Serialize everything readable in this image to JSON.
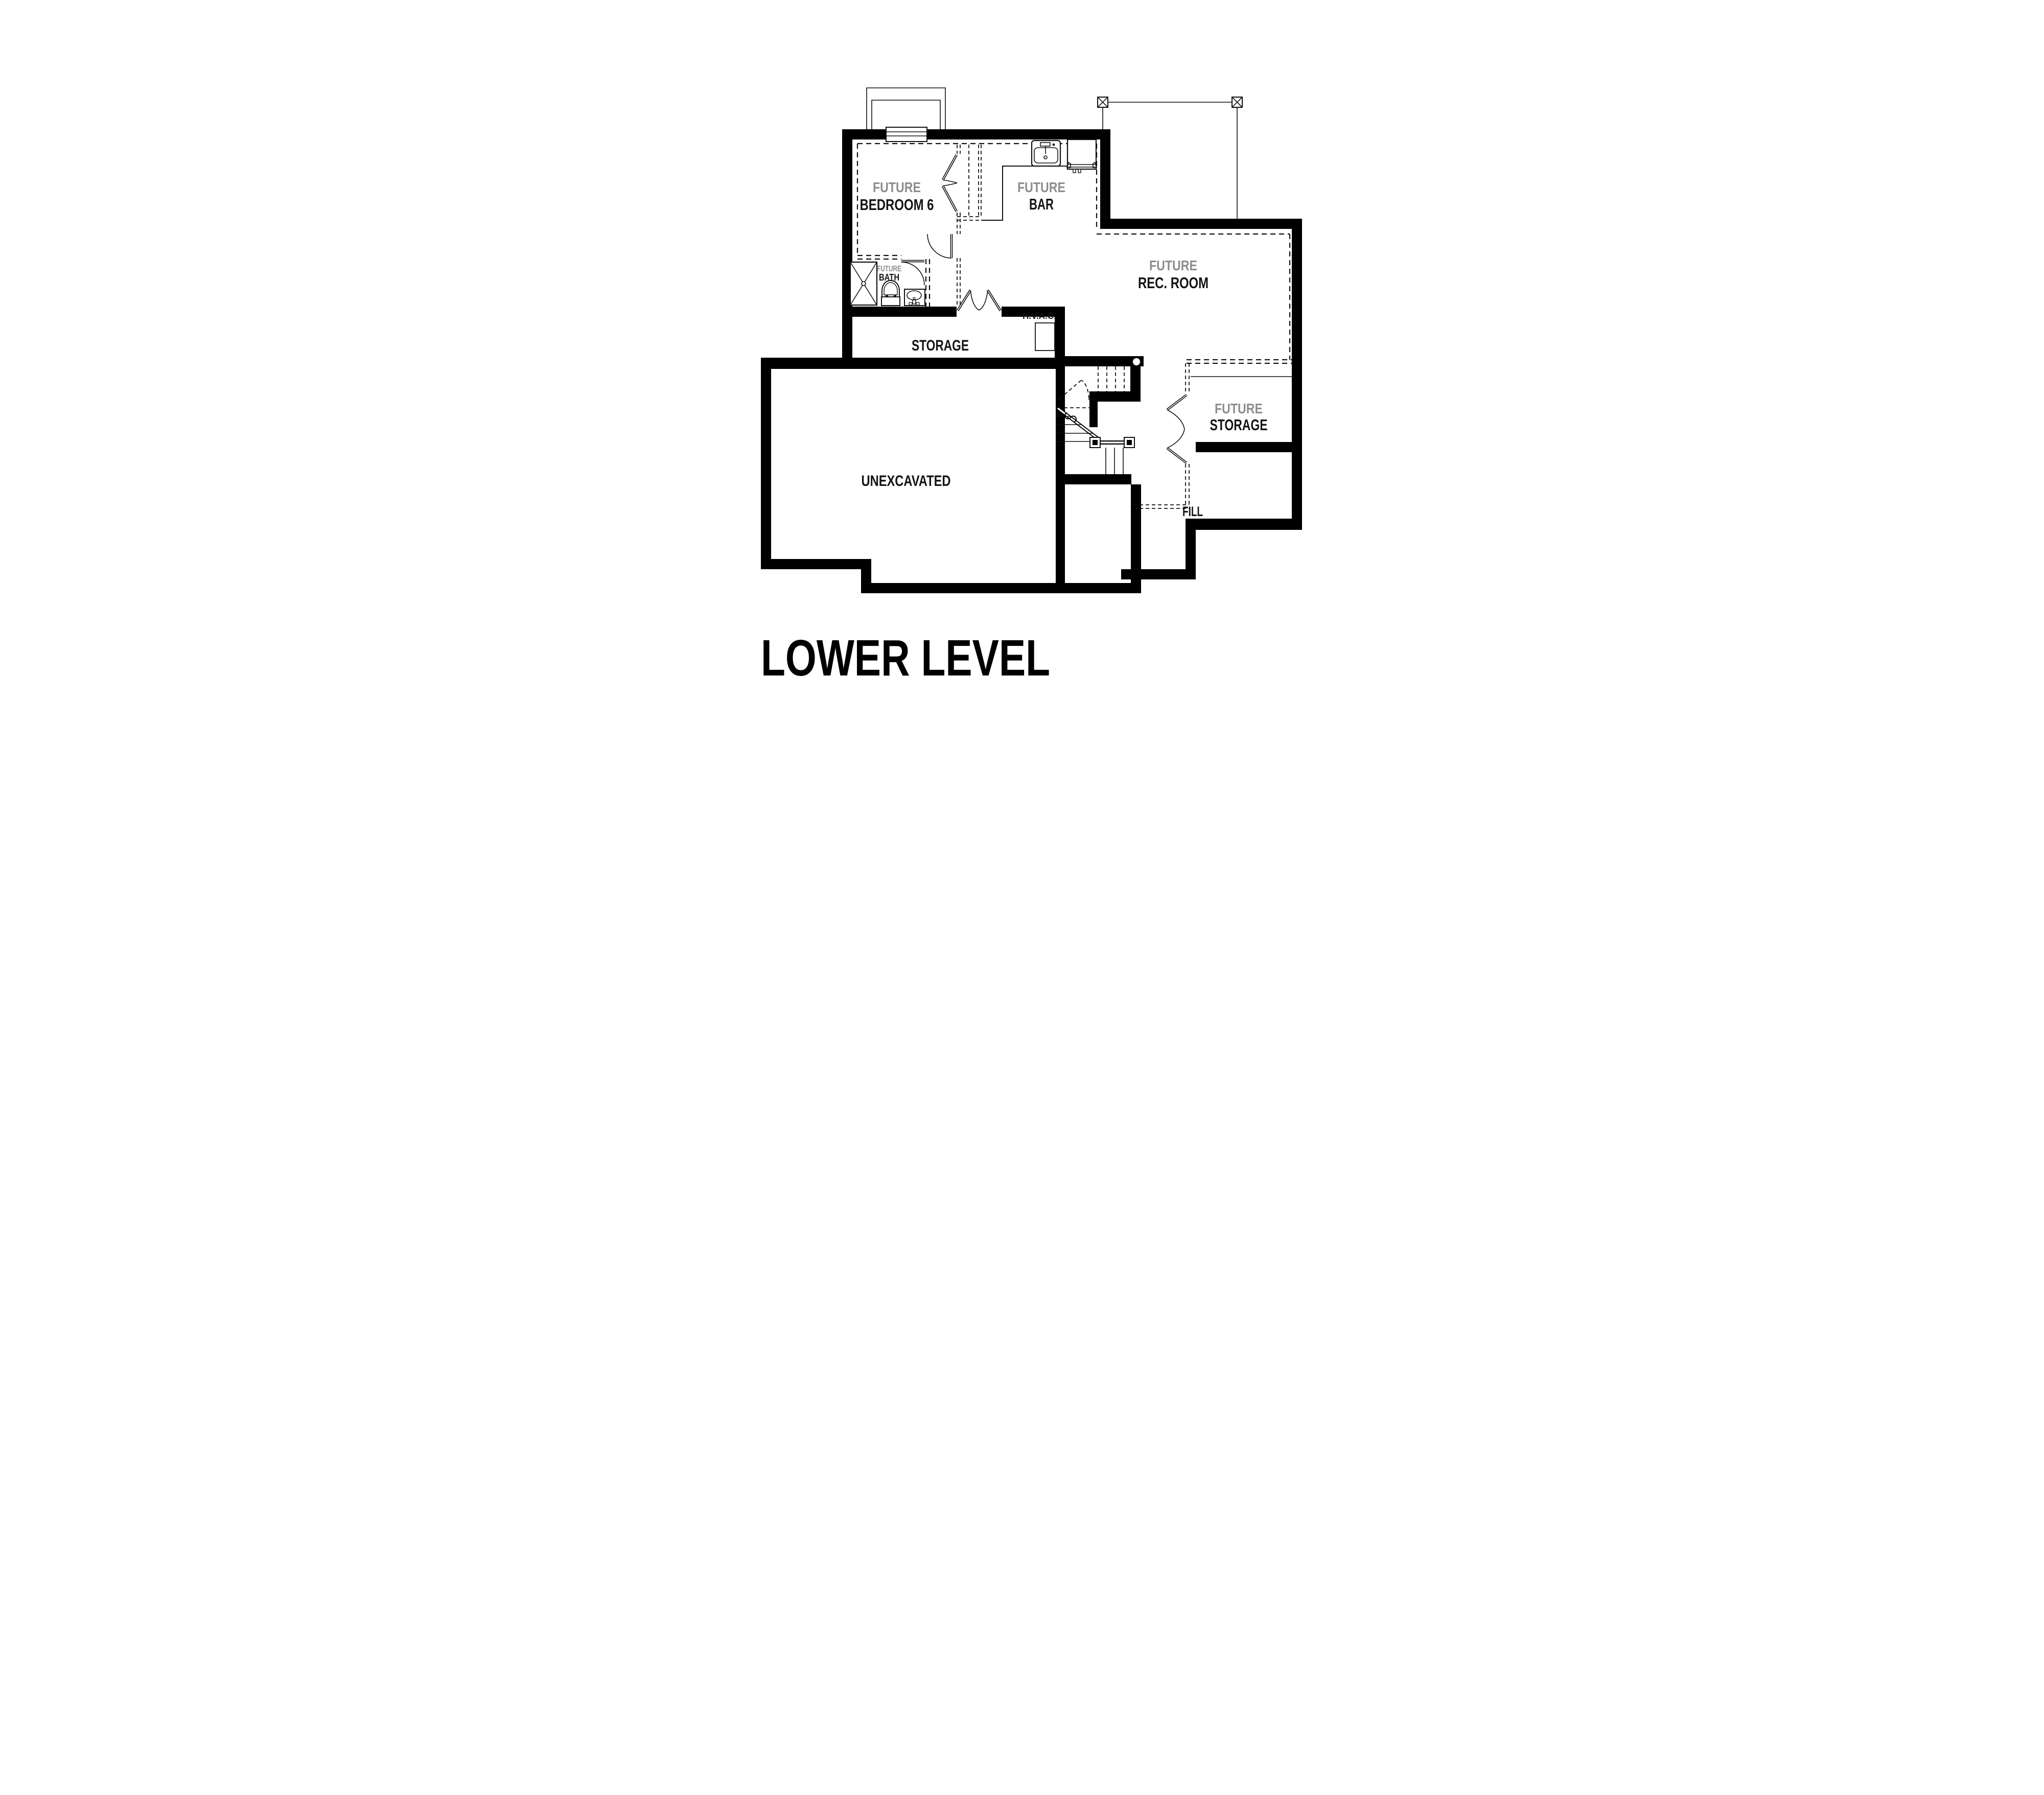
{
  "plan": {
    "title": "LOWER LEVEL",
    "rooms": {
      "bedroom6": {
        "prefix": "FUTURE",
        "name": "BEDROOM 6"
      },
      "bar": {
        "prefix": "FUTURE",
        "name": "BAR"
      },
      "rec_room": {
        "prefix": "FUTURE",
        "name": "REC. ROOM"
      },
      "bath": {
        "prefix": "FUTURE",
        "name": "BATH"
      },
      "storage": {
        "name": "STORAGE"
      },
      "hvac": {
        "name": "H.V.A.C."
      },
      "unexcavated": {
        "name": "UNEXCAVATED"
      },
      "future_storage": {
        "prefix": "FUTURE",
        "name": "STORAGE"
      },
      "fill": {
        "name": "FILL"
      }
    },
    "colors": {
      "wall": "#000000",
      "future_label": "#8d8d8d",
      "room_label": "#141414",
      "background": "#ffffff"
    },
    "legend": {
      "line_weights": "thick solid = foundation walls, dashed = future walls, thin = fixtures"
    }
  }
}
